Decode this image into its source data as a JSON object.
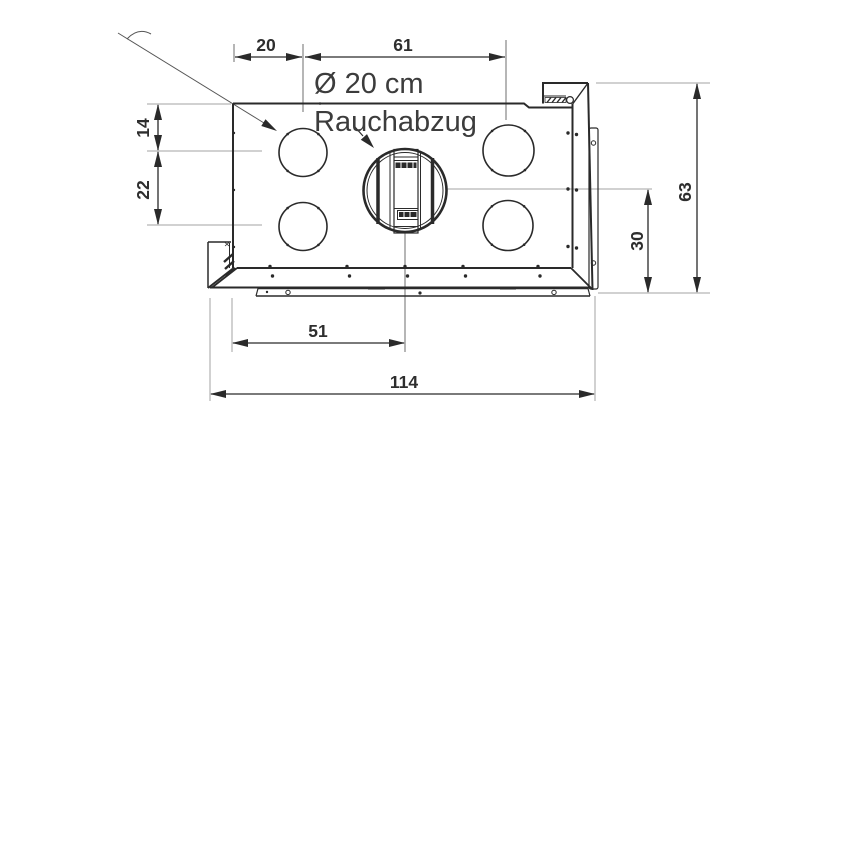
{
  "callout": {
    "diameter": "Ø 20 cm",
    "name": "Rauchabzug"
  },
  "dimensions": {
    "top_left_offset": "20",
    "top_span": "61",
    "left_upper": "14",
    "left_lower": "22",
    "right_total_height": "63",
    "right_lower_height": "30",
    "bottom_half_width": "51",
    "bottom_total_width": "114"
  },
  "colors": {
    "outline": "#2a2a2a",
    "extension_line": "#a3a3a3",
    "leader_line": "#6e6e6e",
    "label_text": "#3c3c3c",
    "dimension_text": "#2e2e2e",
    "background": "#ffffff"
  }
}
